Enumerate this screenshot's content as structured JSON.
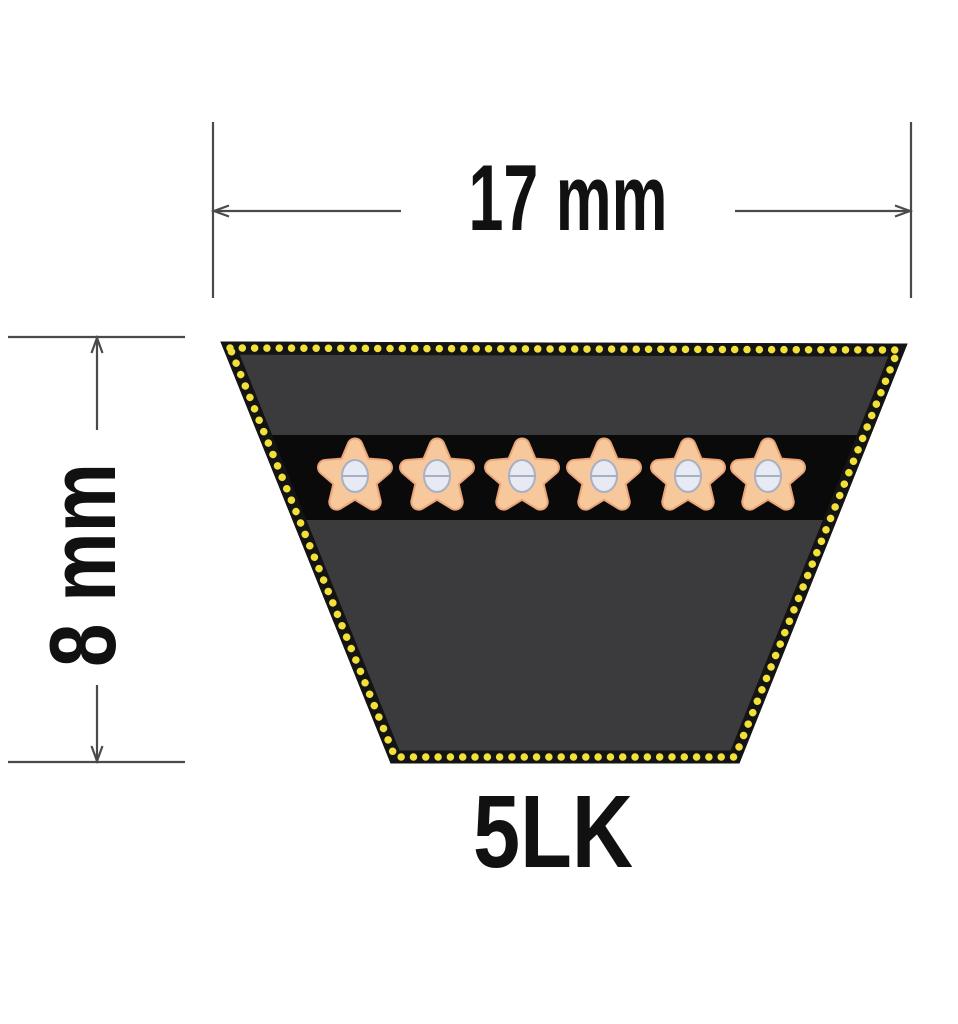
{
  "figure": {
    "type": "v-belt cross-section technical diagram",
    "product_label": "5LK",
    "top_dimension_label": "17 mm",
    "side_dimension_label": "8 mm"
  },
  "cords": {
    "count": 6,
    "centers_x": [
      355,
      437,
      522,
      604,
      688,
      768
    ],
    "center_y": 477
  },
  "colors": {
    "background": "#ffffff",
    "belt_body": "#3b3b3d",
    "belt_border": "#141414",
    "border_dots": "#f2e139",
    "cord_band": "#0a0a0b",
    "star_fill": "#f8c89d",
    "star_outline": "#eaa679",
    "nut_fill": "#e7eaf2",
    "nut_stroke": "#a9b0c4",
    "dimension_line": "#4a4a4a",
    "text": "#111111"
  }
}
